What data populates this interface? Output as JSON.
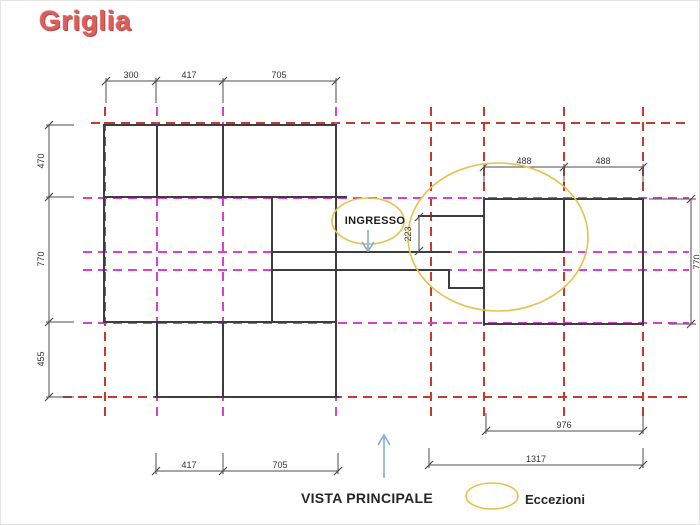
{
  "title": "Griglia",
  "labels": {
    "ingresso": "INGRESSO",
    "vista_principale": "VISTA PRINCIPALE",
    "eccezioni": "Eccezioni"
  },
  "dims": {
    "top": [
      "300",
      "417",
      "705"
    ],
    "left": [
      "470",
      "770",
      "455"
    ],
    "right_top": [
      "488",
      "488"
    ],
    "right_side": "770",
    "entrance": "223",
    "bottom_left": [
      "417",
      "705"
    ],
    "bottom_right_inner": "976",
    "bottom_right_outer": "1317"
  },
  "colors": {
    "title_red": "#d95f5c",
    "grid_red": "#c6392b",
    "grid_magenta": "#d541d5",
    "wall": "#3d3d3d",
    "dim": "#4d4d4d",
    "accent_yellow": "#e5c24b",
    "accent_blue": "#84abd3"
  }
}
